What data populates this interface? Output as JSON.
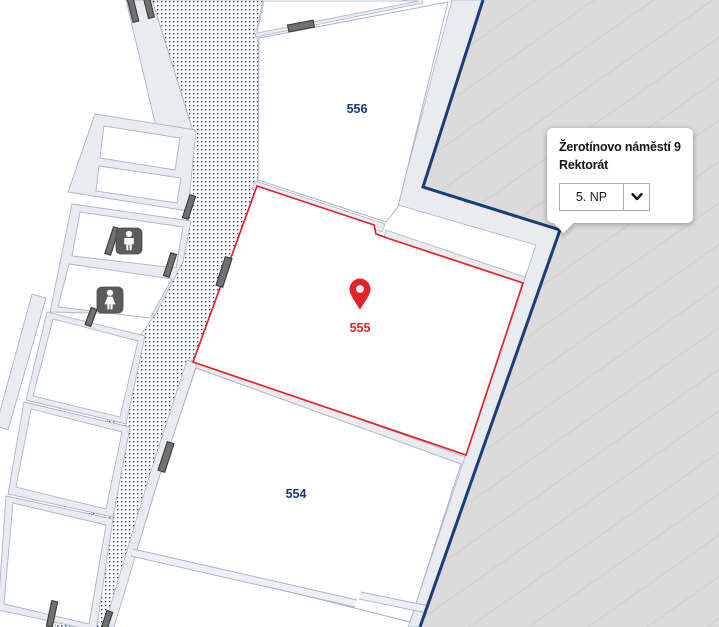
{
  "info_card": {
    "title": "Žerotínovo náměstí 9",
    "subtitle": "Rektorát",
    "floor_select": {
      "value": "5. NP",
      "icon": "chevron-down-icon"
    }
  },
  "rooms": [
    {
      "number": "556",
      "highlighted": false
    },
    {
      "number": "555",
      "highlighted": true,
      "has_marker": true
    },
    {
      "number": "554",
      "highlighted": false
    }
  ],
  "map": {
    "marker_room": "555",
    "symbols": [
      "location-pin-icon",
      "mens-restroom-icon",
      "womens-restroom-icon",
      "door-marker"
    ]
  },
  "colors": {
    "highlight_red": "#e1232a",
    "room_label_navy": "#14357d",
    "building_outline_navy": "#1c3b79",
    "outside_gray": "#dbdbdb",
    "wall_fill_gray": "#e9ebef",
    "wall_line": "#a9b4cb",
    "door_marker_gray": "#717171",
    "restroom_icon_gray": "#5c5c5c",
    "dot_pattern_navy": "#27406f"
  }
}
